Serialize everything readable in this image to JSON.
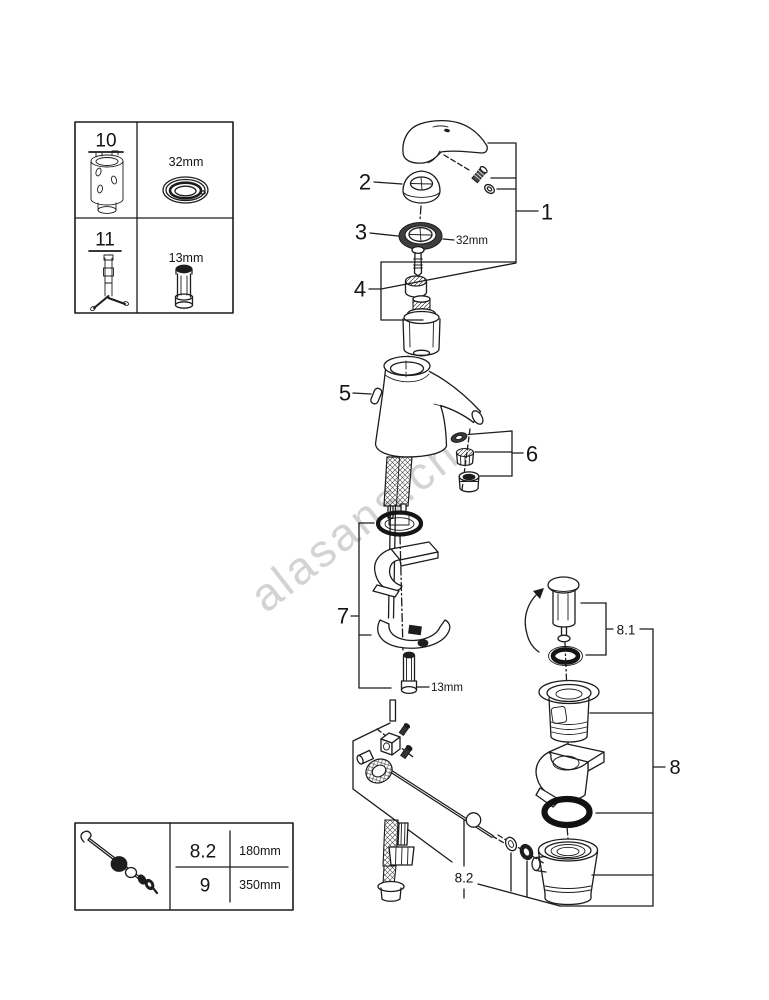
{
  "watermark": {
    "text": "alasans.ch",
    "color": "#c9c9c9"
  },
  "colors": {
    "line": "#1c1c1c",
    "background": "#ffffff"
  },
  "callouts": {
    "n1": "1",
    "n2": "2",
    "n3": "3",
    "n4": "4",
    "n5": "5",
    "n6": "6",
    "n7": "7",
    "n8": "8",
    "n8_1": "8.1",
    "n8_2": "8.2"
  },
  "dims": {
    "ring": "32mm",
    "nut": "13mm"
  },
  "legend_top": {
    "r1_ref": "10",
    "r1_dim": "32mm",
    "r2_ref": "11",
    "r2_dim": "13mm"
  },
  "legend_bottom": {
    "r1_ref": "8.2",
    "r1_dim": "180mm",
    "r2_ref": "9",
    "r2_dim": "350mm"
  }
}
